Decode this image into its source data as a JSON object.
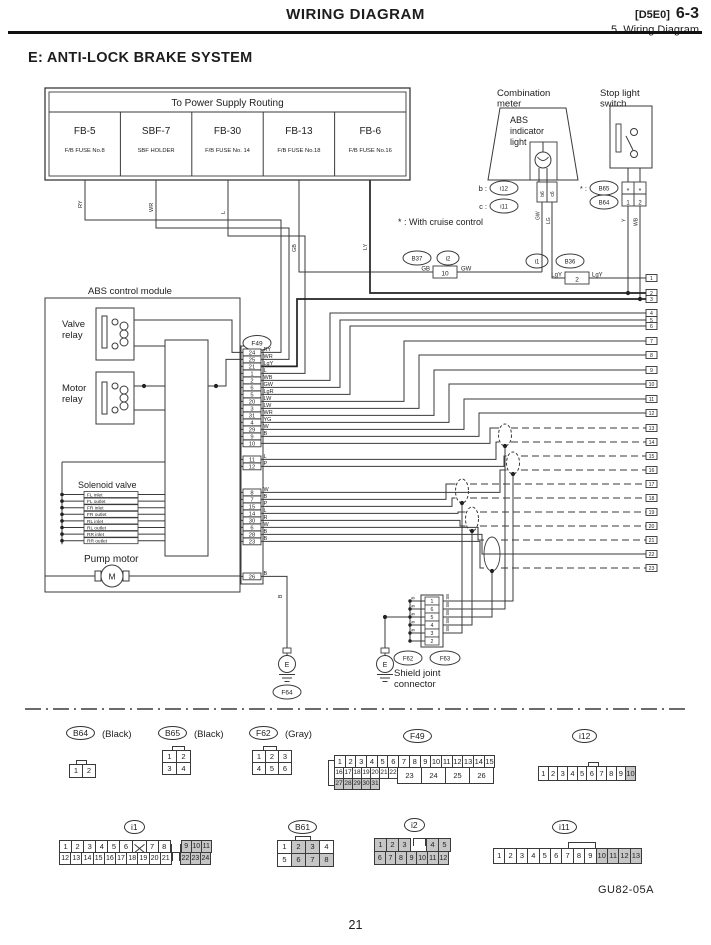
{
  "header": {
    "title": "WIRING DIAGRAM",
    "code": "[D5E0]",
    "number": "6-3",
    "subtitle": "5. Wiring Diagram"
  },
  "section_title": "E: ANTI-LOCK BRAKE SYSTEM",
  "power_supply": {
    "title": "To Power Supply Routing",
    "fuses": [
      {
        "name": "FB-5",
        "sub": "F/B FUSE No.8",
        "wire": "RY"
      },
      {
        "name": "SBF-7",
        "sub": "SBF HOLDER",
        "wire": "WR"
      },
      {
        "name": "FB-30",
        "sub": "F/B FUSE No. 14",
        "wire": "L"
      },
      {
        "name": "FB-13",
        "sub": "F/B FUSE No.18",
        "wire": "GB"
      },
      {
        "name": "FB-6",
        "sub": "F/B FUSE No.16",
        "wire": "LY"
      }
    ]
  },
  "combination_meter": {
    "label1": "Combination",
    "label2": "meter",
    "lamp1": "ABS",
    "lamp2": "indicator",
    "lamp3": "light",
    "rows": [
      {
        "prefix": "b :",
        "connector": "i12",
        "pin": "b6",
        "wire": "GW"
      },
      {
        "prefix": "c :",
        "connector": "i11",
        "pin": "c6",
        "wire": "LG"
      }
    ]
  },
  "stop_light_switch": {
    "label1": "Stop light",
    "label2": "switch",
    "star_prefix": "* :",
    "conn_top": "B65",
    "conn_bottom": "B64",
    "pin_star": "*",
    "pins": [
      "1",
      "2"
    ],
    "wires": [
      "Y",
      "WB"
    ]
  },
  "cruise_note": "* : With cruise control",
  "inline_connectors": [
    {
      "oval1": "B37",
      "oval2": "i2",
      "left": "GB",
      "pin": "10",
      "right": "GW"
    },
    {
      "oval1": "i1",
      "oval2": "B36",
      "left": "LgY",
      "pin": "2",
      "right": "LgY"
    }
  ],
  "abs_module": {
    "label": "ABS control module",
    "valve1": "Valve",
    "valve2": "relay",
    "motor1": "Motor",
    "motor2": "relay",
    "solenoid_label": "Solenoid valve",
    "solenoids": [
      "FL inlet",
      "FL outlet",
      "FR inlet",
      "FR outlet",
      "RL inlet",
      "RL outlet",
      "RR inlet",
      "RR outlet"
    ],
    "pump_label": "Pump motor",
    "motor_symbol": "M"
  },
  "f49": {
    "name": "F49",
    "pins_upper": [
      {
        "n": "24",
        "c": "RY"
      },
      {
        "n": "25",
        "c": "WR"
      },
      {
        "n": "21",
        "c": "LgY"
      },
      {
        "n": "1",
        "c": "L"
      },
      {
        "n": "2",
        "c": "WB"
      },
      {
        "n": "6",
        "c": "GW"
      },
      {
        "n": "5",
        "c": "LgR"
      },
      {
        "n": "20",
        "c": "LW"
      },
      {
        "n": "3",
        "c": "LW"
      },
      {
        "n": "31",
        "c": "WR"
      },
      {
        "n": "4",
        "c": "YG"
      },
      {
        "n": "29",
        "c": "W"
      },
      {
        "n": "9",
        "c": "B"
      },
      {
        "n": "10",
        "c": ""
      }
    ],
    "pins_mid": [
      {
        "n": "11",
        "c": "L"
      },
      {
        "n": "12",
        "c": "P"
      }
    ],
    "pins_lower": [
      {
        "n": "8",
        "c": "W"
      },
      {
        "n": "7",
        "c": "B"
      },
      {
        "n": "15",
        "c": "P"
      },
      {
        "n": "14",
        "c": "L"
      },
      {
        "n": "30",
        "c": "R"
      },
      {
        "n": "6",
        "c": "W"
      },
      {
        "n": "28",
        "c": "B"
      },
      {
        "n": "23",
        "c": "B"
      }
    ],
    "pin_ground": {
      "n": "26",
      "c": "B"
    }
  },
  "right_terminals": [
    "1",
    "2",
    "3",
    "4",
    "5",
    "6",
    "7",
    "8",
    "9",
    "10",
    "11",
    "12",
    "13",
    "14",
    "15",
    "16",
    "17",
    "18",
    "19",
    "20",
    "21",
    "22",
    "23"
  ],
  "shield": {
    "pins": [
      "1",
      "6",
      "5",
      "4",
      "3",
      "2"
    ],
    "left_wire": "B",
    "right_wire": "SB",
    "oval1": "F62",
    "oval2": "F63",
    "label1": "Shield joint",
    "label2": "connector"
  },
  "grounds": {
    "symbol": "E",
    "f64": "F64",
    "wire": "B"
  },
  "bottom": {
    "b64": {
      "name": "B64",
      "color": "(Black)",
      "cells": [
        "1",
        "2"
      ]
    },
    "b65": {
      "name": "B65",
      "color": "(Black)",
      "row1": [
        "1",
        "2"
      ],
      "row2": [
        "3",
        "4"
      ]
    },
    "f62": {
      "name": "F62",
      "color": "(Gray)",
      "row1": [
        "1",
        "2",
        "3"
      ],
      "row2": [
        "4",
        "5",
        "6"
      ]
    },
    "f49": {
      "name": "F49",
      "row1": [
        "1",
        "2",
        "3",
        "4",
        "5",
        "6",
        "7",
        "8",
        "9",
        "10",
        "11",
        "12",
        "13",
        "14",
        "15"
      ],
      "row2a": [
        "16",
        "17",
        "18",
        "19",
        "20",
        "21",
        "22"
      ],
      "row2b": [
        "23",
        "24",
        "25",
        "26"
      ],
      "row3": [
        "27",
        "28",
        "29",
        "30",
        "31"
      ]
    },
    "i12": {
      "name": "i12",
      "rowa": [
        "1",
        "2",
        "3",
        "4",
        "5",
        "6",
        "7",
        "8",
        "9"
      ],
      "rowb": [
        "10"
      ]
    },
    "i1": {
      "name": "i1",
      "row1a": [
        "1",
        "2",
        "3",
        "4",
        "5",
        "6"
      ],
      "row1b": [
        "7",
        "8"
      ],
      "row1c": [
        "9",
        "10",
        "11"
      ],
      "row2a": [
        "12",
        "13",
        "14",
        "15",
        "16",
        "17",
        "18",
        "19",
        "20",
        "21"
      ],
      "row2b": [
        "22",
        "23",
        "24"
      ]
    },
    "b61": {
      "name": "B61",
      "row1a": [
        "1"
      ],
      "row1b": [
        "2",
        "3"
      ],
      "row1c": [
        "4"
      ],
      "row2a": [
        "5"
      ],
      "row2b": [
        "6",
        "7",
        "8"
      ]
    },
    "i2": {
      "name": "i2",
      "row1a": [
        "1",
        "2",
        "3"
      ],
      "row1b": [
        "4",
        "5"
      ],
      "row2": [
        "6",
        "7",
        "8",
        "9",
        "10",
        "11",
        "12"
      ]
    },
    "i11": {
      "name": "i11",
      "rowa": [
        "1",
        "2",
        "3",
        "4",
        "5",
        "6",
        "7",
        "8",
        "9"
      ],
      "rowb": [
        "10",
        "11",
        "12",
        "13"
      ]
    }
  },
  "footer": {
    "code": "GU82-05A",
    "page": "21"
  }
}
